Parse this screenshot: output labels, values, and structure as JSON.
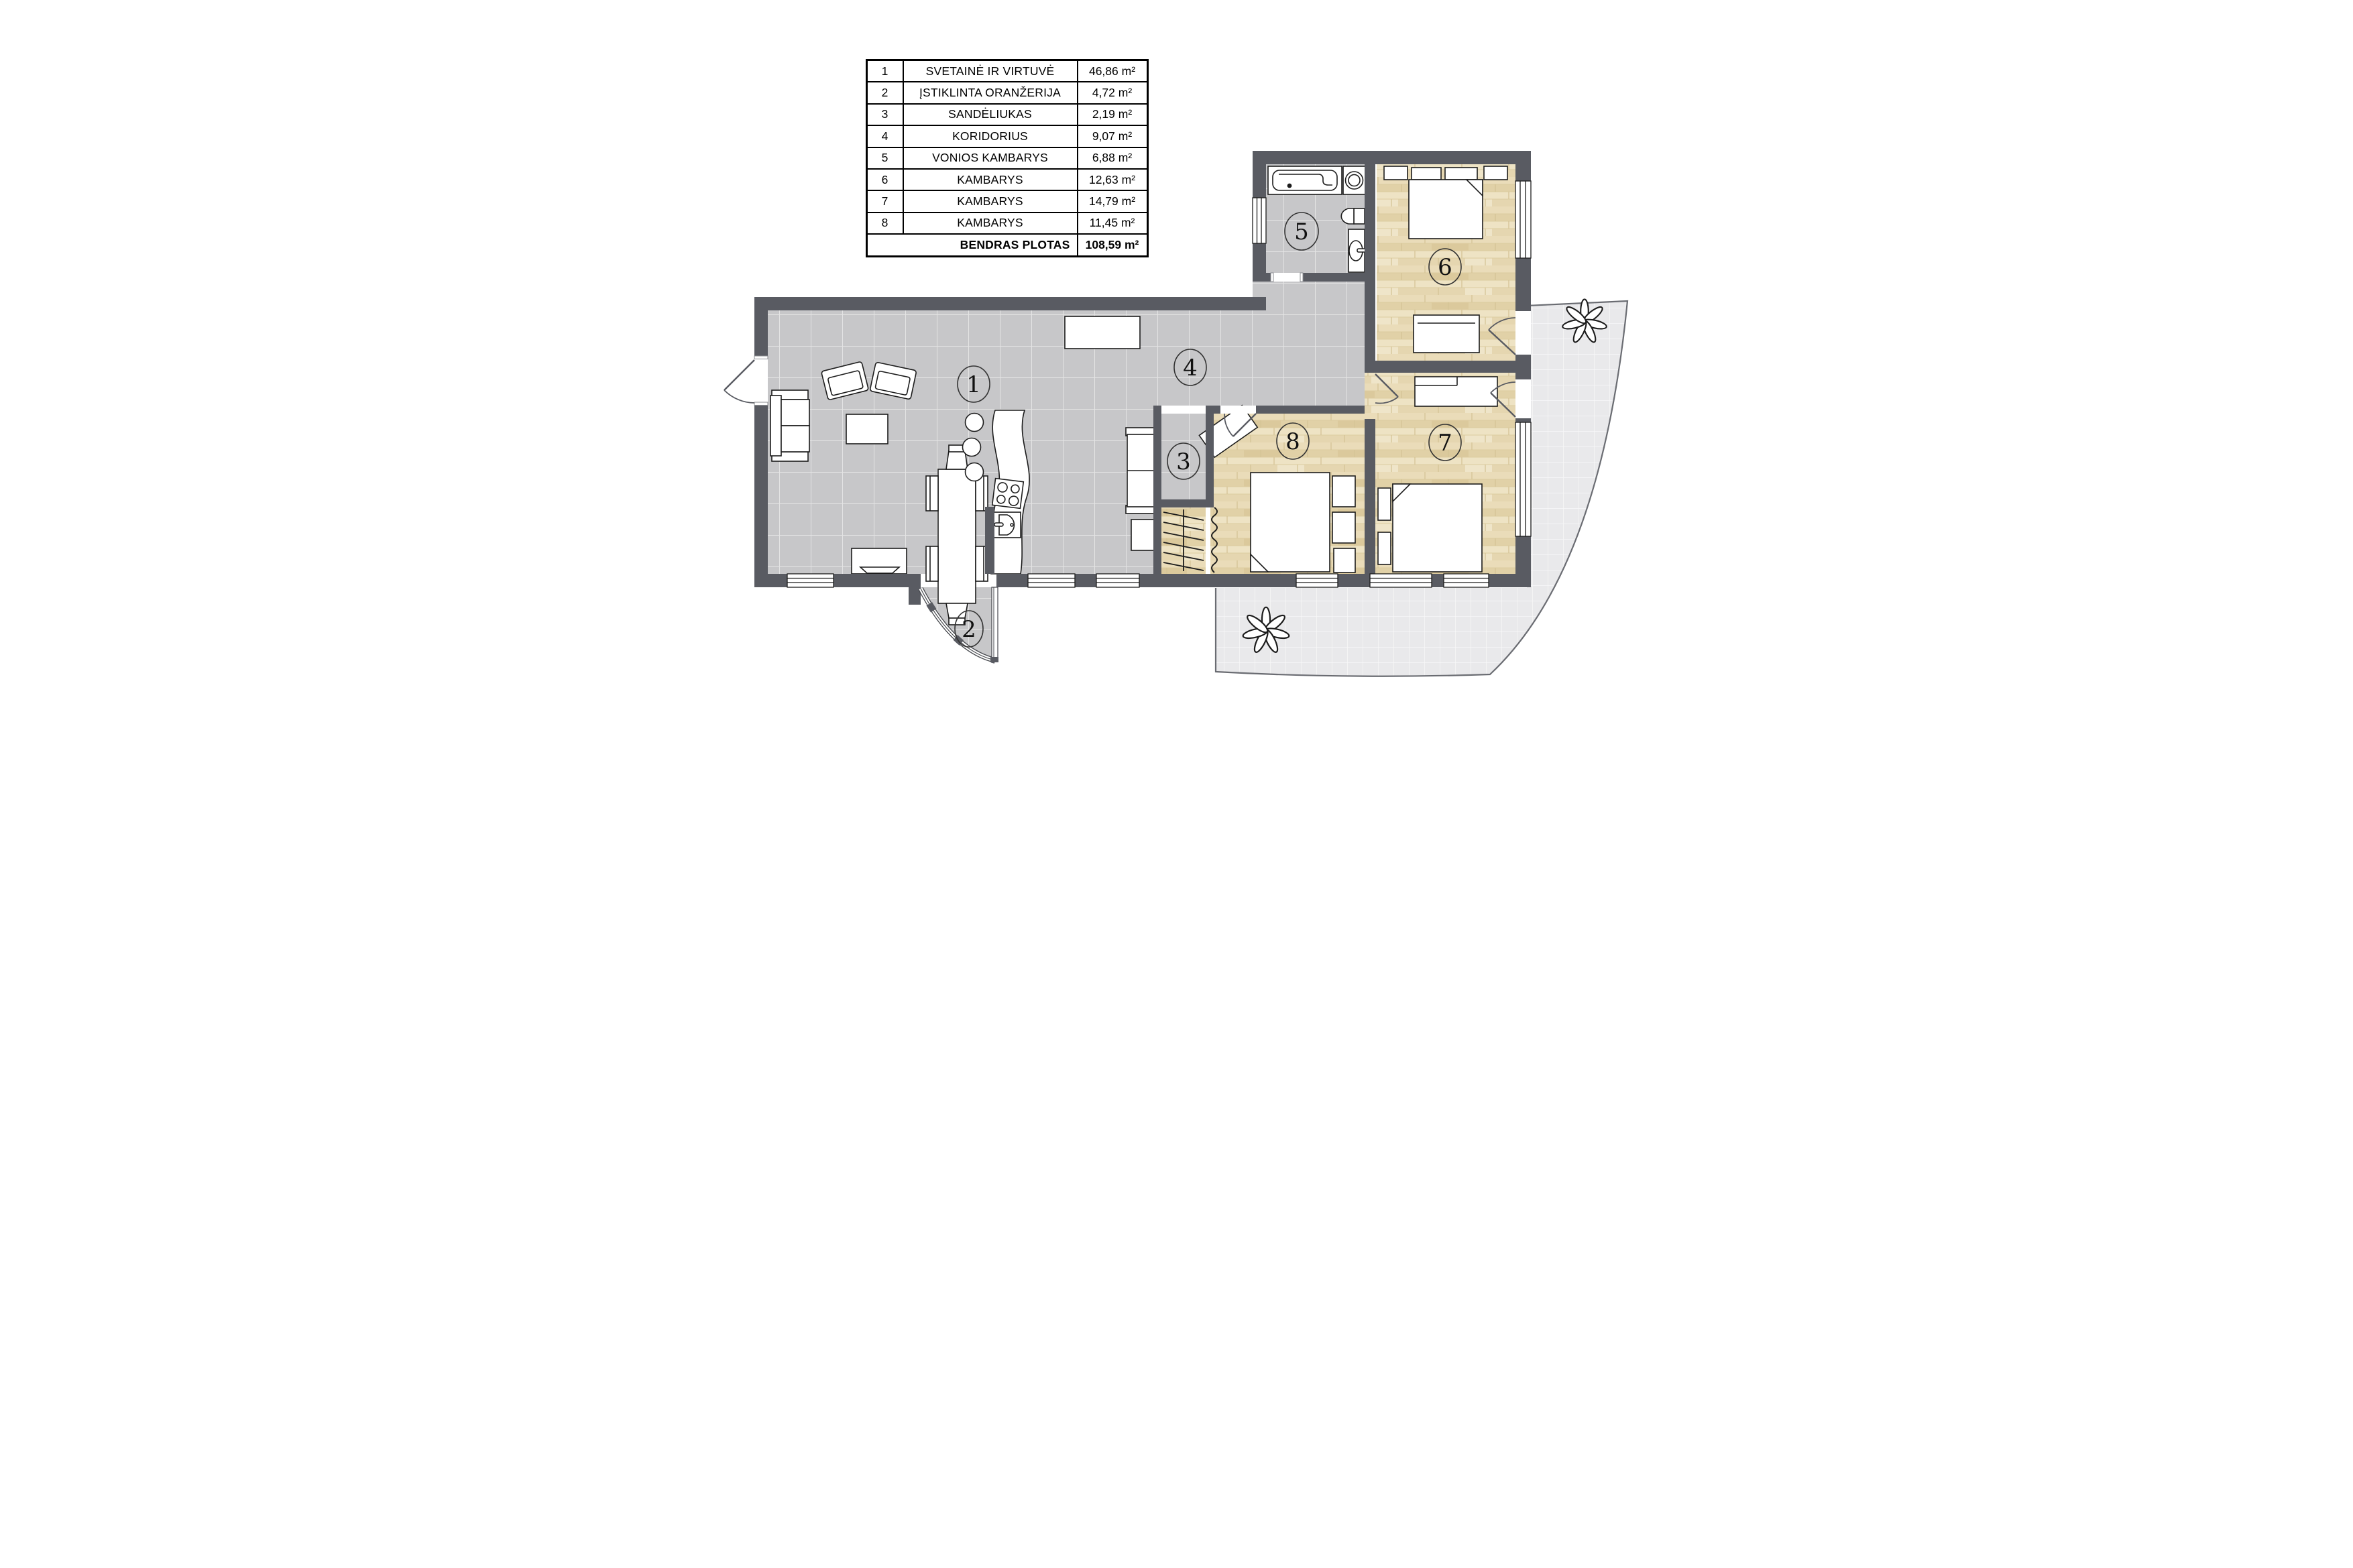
{
  "legend": {
    "rows": [
      {
        "num": "1",
        "name": "SVETAINĖ IR VIRTUVĖ",
        "area": "46,86 m²"
      },
      {
        "num": "2",
        "name": "ĮSTIKLINTA ORANŽERIJA",
        "area": "4,72 m²"
      },
      {
        "num": "3",
        "name": "SANDĖLIUKAS",
        "area": "2,19 m²"
      },
      {
        "num": "4",
        "name": "KORIDORIUS",
        "area": "9,07 m²"
      },
      {
        "num": "5",
        "name": "VONIOS KAMBARYS",
        "area": "6,88 m²"
      },
      {
        "num": "6",
        "name": "KAMBARYS",
        "area": "12,63 m²"
      },
      {
        "num": "7",
        "name": "KAMBARYS",
        "area": "14,79 m²"
      },
      {
        "num": "8",
        "name": "KAMBARYS",
        "area": "11,45 m²"
      }
    ],
    "total": {
      "label": "BENDRAS PLOTAS",
      "area": "108,59 m²"
    }
  },
  "plan": {
    "labels": [
      "1",
      "2",
      "3",
      "4",
      "5",
      "6",
      "7",
      "8"
    ],
    "colors": {
      "wall": "#595b62",
      "tile_floor": "#c7c7c9",
      "wood_floor": "#e7d9b4",
      "patio": "#e9e9eb",
      "outline": "#1c1c1c"
    }
  }
}
